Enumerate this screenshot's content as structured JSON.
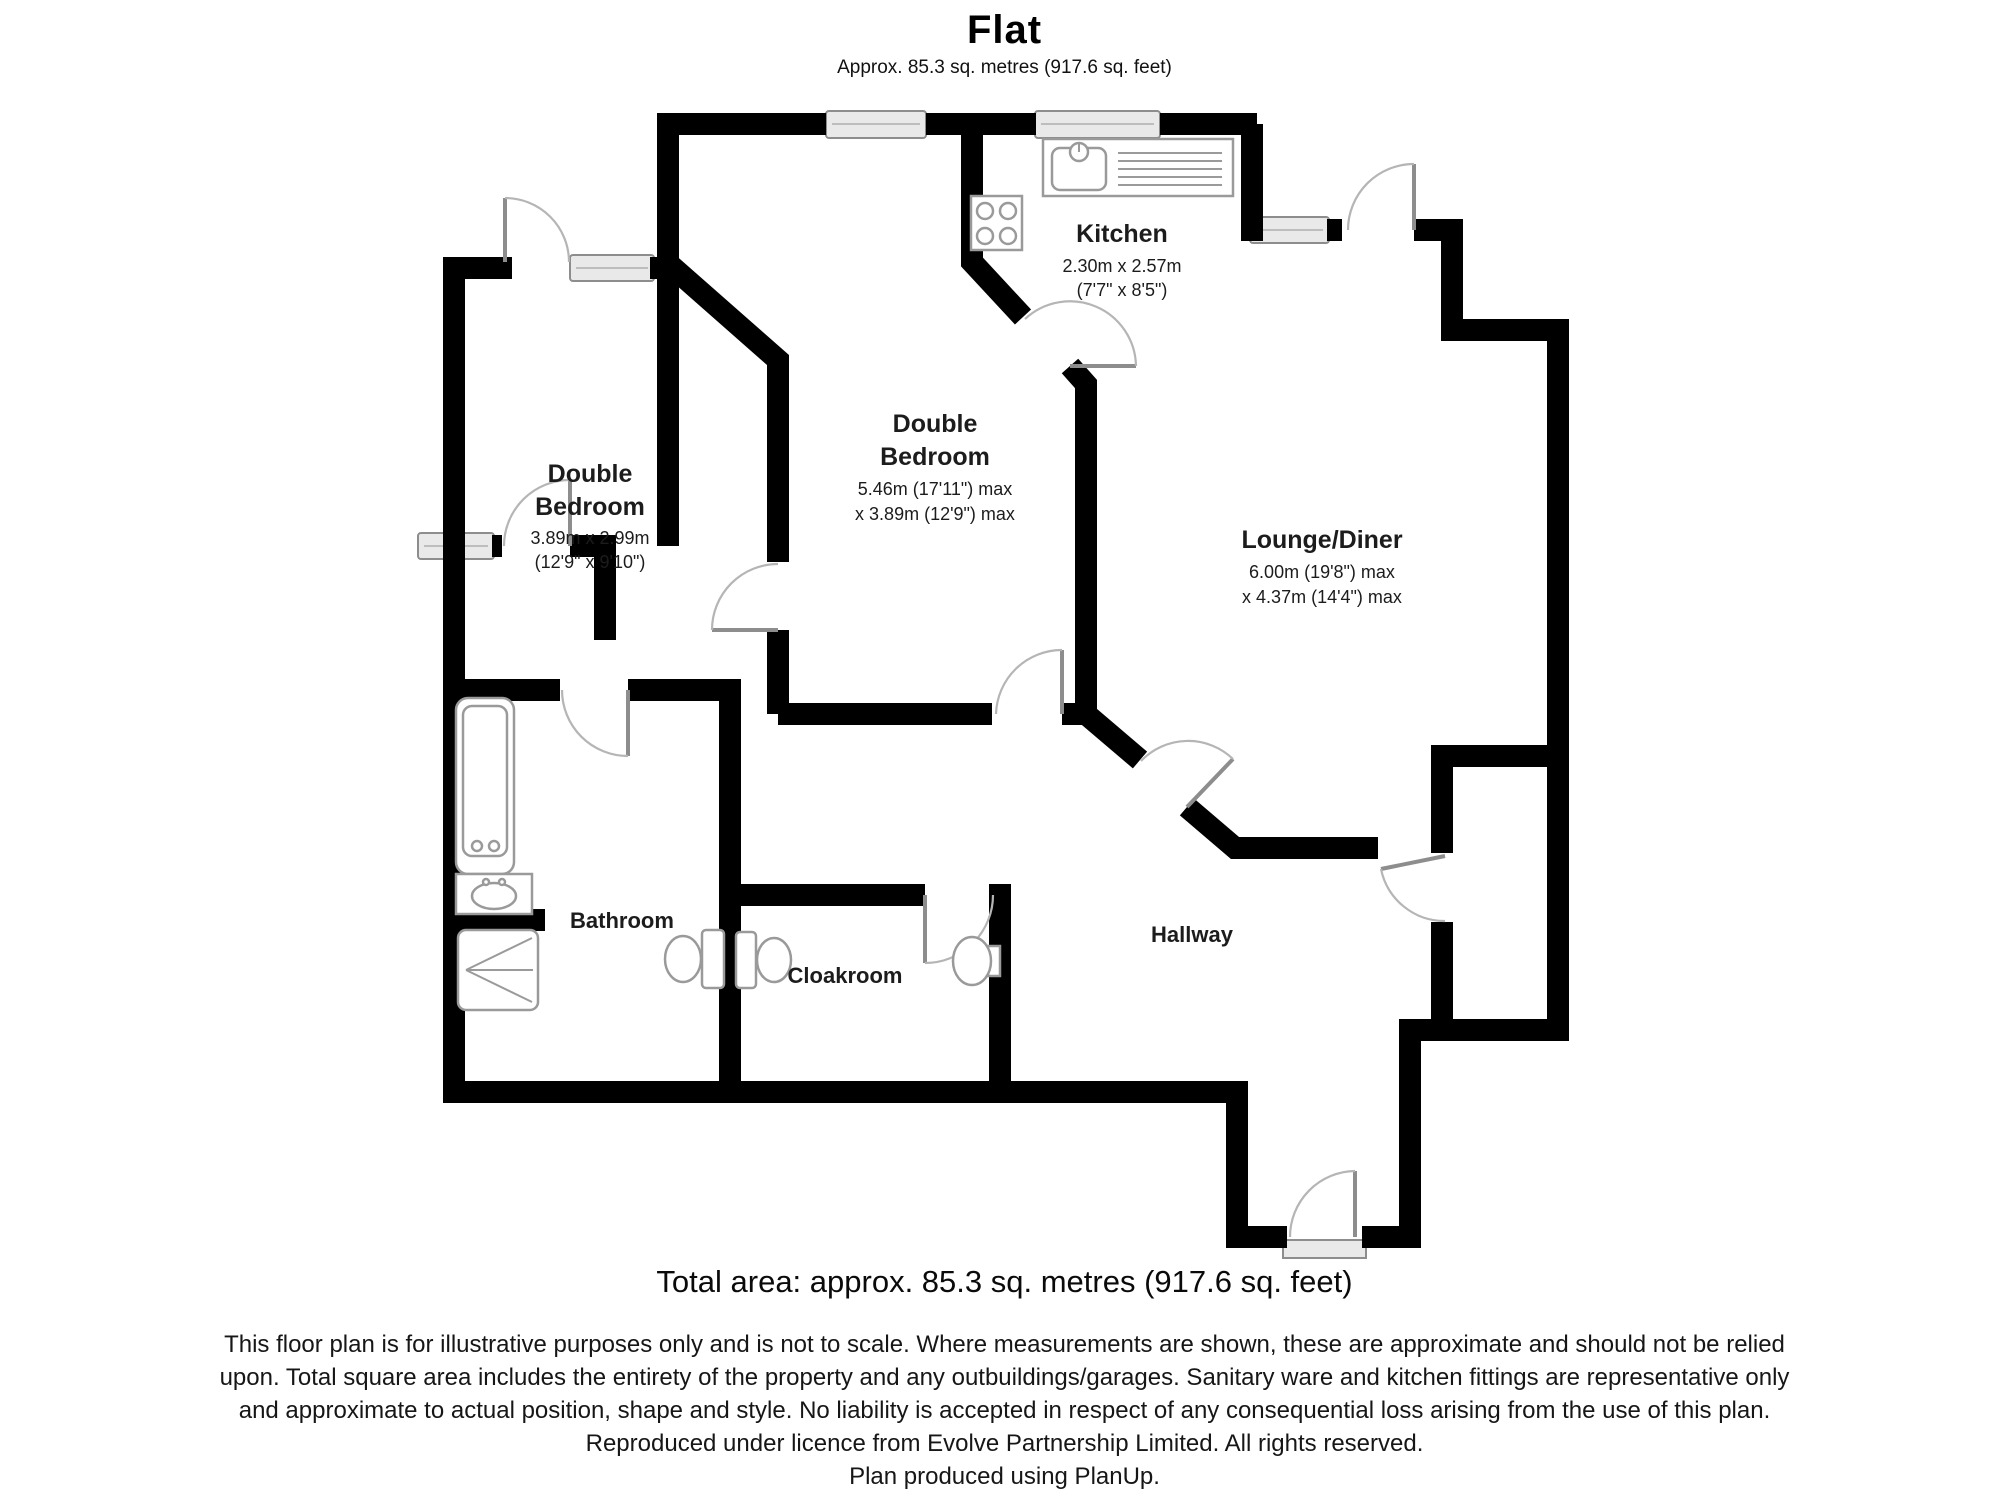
{
  "header": {
    "title": "Flat",
    "subtitle": "Approx. 85.3 sq. metres (917.6 sq. feet)"
  },
  "rooms": {
    "kitchen": {
      "name": "Kitchen",
      "dim_line1": "2.30m x 2.57m",
      "dim_line2": "(7'7\" x 8'5\")"
    },
    "bedroom_middle": {
      "name_line1": "Double",
      "name_line2": "Bedroom",
      "dim_line1": "5.46m (17'11\") max",
      "dim_line2": "x 3.89m (12'9\") max"
    },
    "bedroom_left": {
      "name_line1": "Double",
      "name_line2": "Bedroom",
      "dim_line1": "3.89m x 2.99m",
      "dim_line2": "(12'9\" x 9'10\")"
    },
    "lounge": {
      "name": "Lounge/Diner",
      "dim_line1": "6.00m (19'8\") max",
      "dim_line2": "x 4.37m (14'4\") max"
    },
    "bathroom": {
      "name": "Bathroom"
    },
    "cloakroom": {
      "name": "Cloakroom"
    },
    "hallway": {
      "name": "Hallway"
    }
  },
  "footer": {
    "total_area": "Total area: approx. 85.3 sq. metres (917.6 sq. feet)",
    "disclaimer_lines": [
      "This floor plan is for illustrative purposes only and is not to scale.  Where measurements are shown, these are approximate and should not be relied",
      "upon. Total square area includes the entirety of the property and any outbuildings/garages. Sanitary ware and kitchen fittings are representative only",
      "and approximate to actual position, shape and style.  No liability is accepted in respect of any consequential loss arising from the use of this plan.",
      "Reproduced under licence from Evolve Partnership Limited. All rights reserved.",
      "Plan produced using PlanUp."
    ]
  }
}
